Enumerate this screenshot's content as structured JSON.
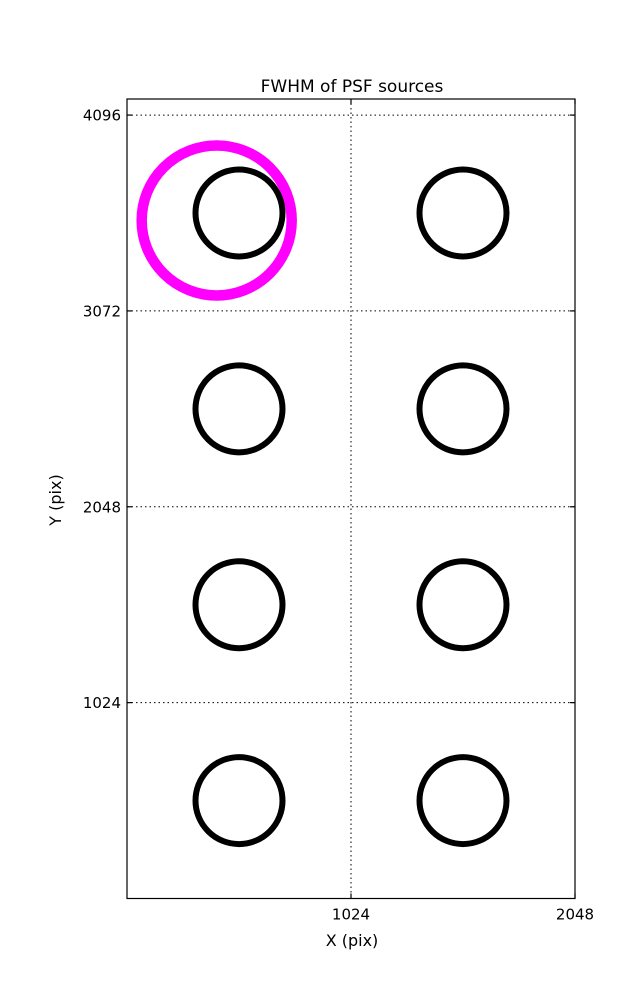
{
  "figure": {
    "title": "FWHM of PSF sources",
    "x_axis_label": "X (pix)",
    "y_axis_label": "Y (pix)"
  },
  "colors": {
    "background": "#ffffff",
    "axis": "#000000",
    "text": "#000000",
    "marker": "#000000",
    "highlight": "#ff00ff"
  },
  "chart_data": {
    "type": "scatter",
    "title": "FWHM of PSF sources",
    "xlabel": "X (pix)",
    "ylabel": "Y (pix)",
    "xlim": [
      0,
      2048
    ],
    "ylim": [
      0,
      4180
    ],
    "xticks": [
      1024,
      2048
    ],
    "yticks": [
      1024,
      2048,
      3072,
      4096
    ],
    "grid": {
      "style": "dotted",
      "color": "#000000",
      "x_gridlines": [
        1024
      ],
      "y_gridlines": [
        1024,
        2048,
        3072,
        4096
      ]
    },
    "legend": "none",
    "marker_color": "#000000",
    "marker_radius_px": 43.5,
    "marker_stroke_px": 6,
    "sources": [
      {
        "x": 512,
        "y": 3584
      },
      {
        "x": 1536,
        "y": 3584
      },
      {
        "x": 512,
        "y": 2560
      },
      {
        "x": 1536,
        "y": 2560
      },
      {
        "x": 512,
        "y": 1536
      },
      {
        "x": 1536,
        "y": 1536
      },
      {
        "x": 512,
        "y": 512
      },
      {
        "x": 1536,
        "y": 512
      }
    ],
    "highlight": {
      "x": 410,
      "y": 3545,
      "radius_px": 75,
      "stroke_px": 10.5,
      "color": "#ff00ff"
    }
  }
}
